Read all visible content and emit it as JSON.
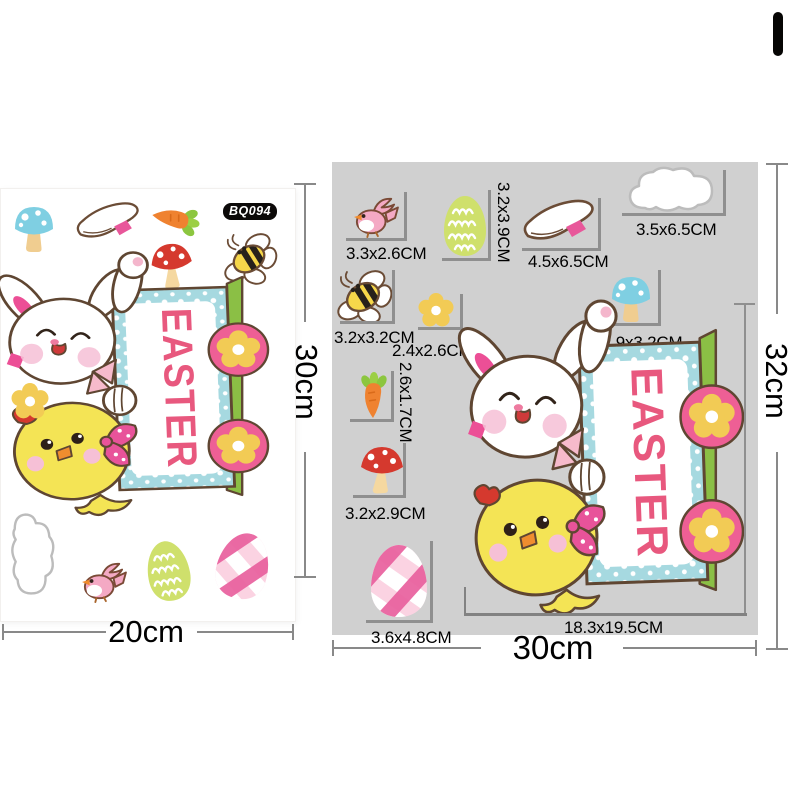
{
  "product_code": "BQ094",
  "sign_text": "EASTER",
  "left_panel": {
    "description": "sticker sheet",
    "width_label": "20cm",
    "height_label": "30cm"
  },
  "right_panel": {
    "description": "individual sticker sizes",
    "width_label": "30cm",
    "height_label": "32cm",
    "items": [
      {
        "id": "bird",
        "size": "3.3x2.6CM"
      },
      {
        "id": "green-egg",
        "size": "3.2x3.9CM"
      },
      {
        "id": "slipper",
        "size": "4.5x6.5CM"
      },
      {
        "id": "cloud",
        "size": "3.5x6.5CM"
      },
      {
        "id": "bee",
        "size": "3.2x3.2CM"
      },
      {
        "id": "flower",
        "size": "2.4x2.6CM"
      },
      {
        "id": "blue-mushroom",
        "size": "2.9x3.2CM"
      },
      {
        "id": "carrot",
        "size": "2.6x1.7CM"
      },
      {
        "id": "red-mushroom",
        "size": "3.2x2.9CM"
      },
      {
        "id": "plaid-egg",
        "size": "3.6x4.8CM"
      },
      {
        "id": "bunny-sign",
        "size": "18.3x19.5CM"
      }
    ]
  },
  "colors": {
    "panel_bg": "#d0d0d0",
    "badge_bg": "#0c0a09",
    "easter_text": "#e8587e",
    "sign_teal": "#a6d9e0",
    "accent_pink": "#ee5f95",
    "chick_yellow": "#f4e455",
    "post_green": "#8bbf45",
    "bracket_gray": "#8f8f8f"
  }
}
